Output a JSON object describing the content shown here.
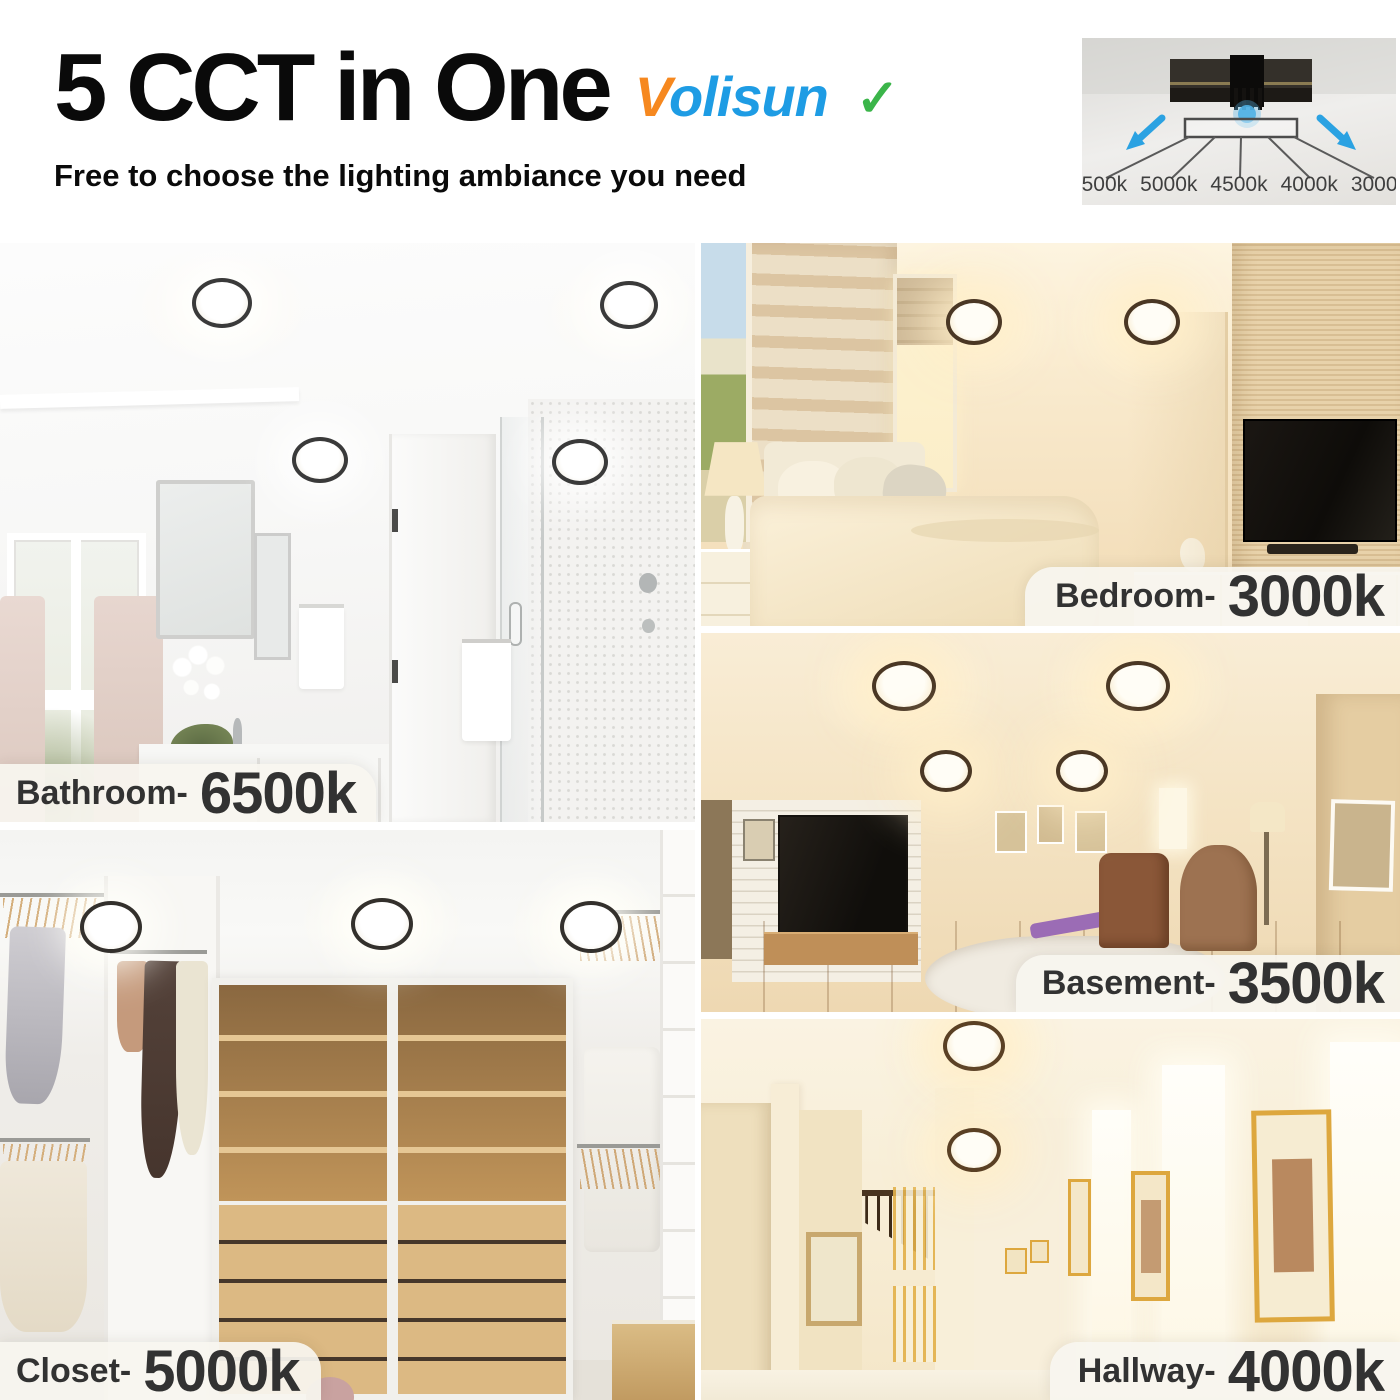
{
  "header": {
    "title": "5 CCT in One",
    "subtitle": "Free to choose the lighting ambiance you need",
    "brand": {
      "first": "V",
      "rest": "olisun",
      "check": "✓"
    }
  },
  "cct_diagram": {
    "options": [
      "6500k",
      "5000k",
      "4500k",
      "4000k",
      "3000k"
    ]
  },
  "rooms": [
    {
      "id": "bathroom",
      "label": "Bathroom-",
      "cct": "6500k"
    },
    {
      "id": "bedroom",
      "label": "Bedroom-",
      "cct": "3000k"
    },
    {
      "id": "basement",
      "label": "Basement-",
      "cct": "3500k"
    },
    {
      "id": "closet",
      "label": "Closet-",
      "cct": "5000k"
    },
    {
      "id": "hallway",
      "label": "Hallway-",
      "cct": "4000k"
    }
  ],
  "colors": {
    "brand_orange": "#F6881F",
    "brand_blue": "#1E9CE4",
    "check_green": "#3BB54A",
    "arrow_blue": "#2BA2E2",
    "label_text": "#323232"
  }
}
